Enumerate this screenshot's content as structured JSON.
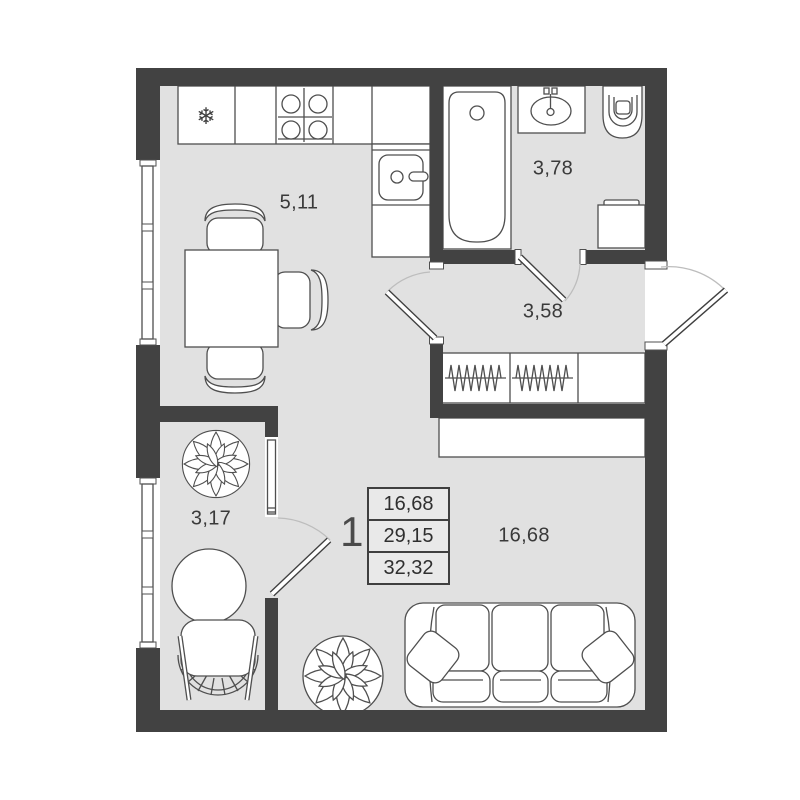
{
  "floorplan": {
    "unit_number": "1",
    "rooms": {
      "kitchen_living": {
        "area": "5,11"
      },
      "bathroom": {
        "area": "3,78"
      },
      "hallway": {
        "area": "3,58"
      },
      "closet": {
        "area": "3,17"
      },
      "living_room": {
        "area": "16,68"
      }
    },
    "area_table": {
      "living_area": "16,68",
      "apartment_area": "29,15",
      "total_area": "32,32"
    },
    "icons": {
      "snowflake": "❄"
    },
    "colors": {
      "wall": "#424242",
      "floor": "#e1e1e1",
      "furniture_outline": "#4f4f4f",
      "swing_arc": "#bdbdbd",
      "background": "#ffffff",
      "label_text": "#3a3a3a"
    }
  }
}
